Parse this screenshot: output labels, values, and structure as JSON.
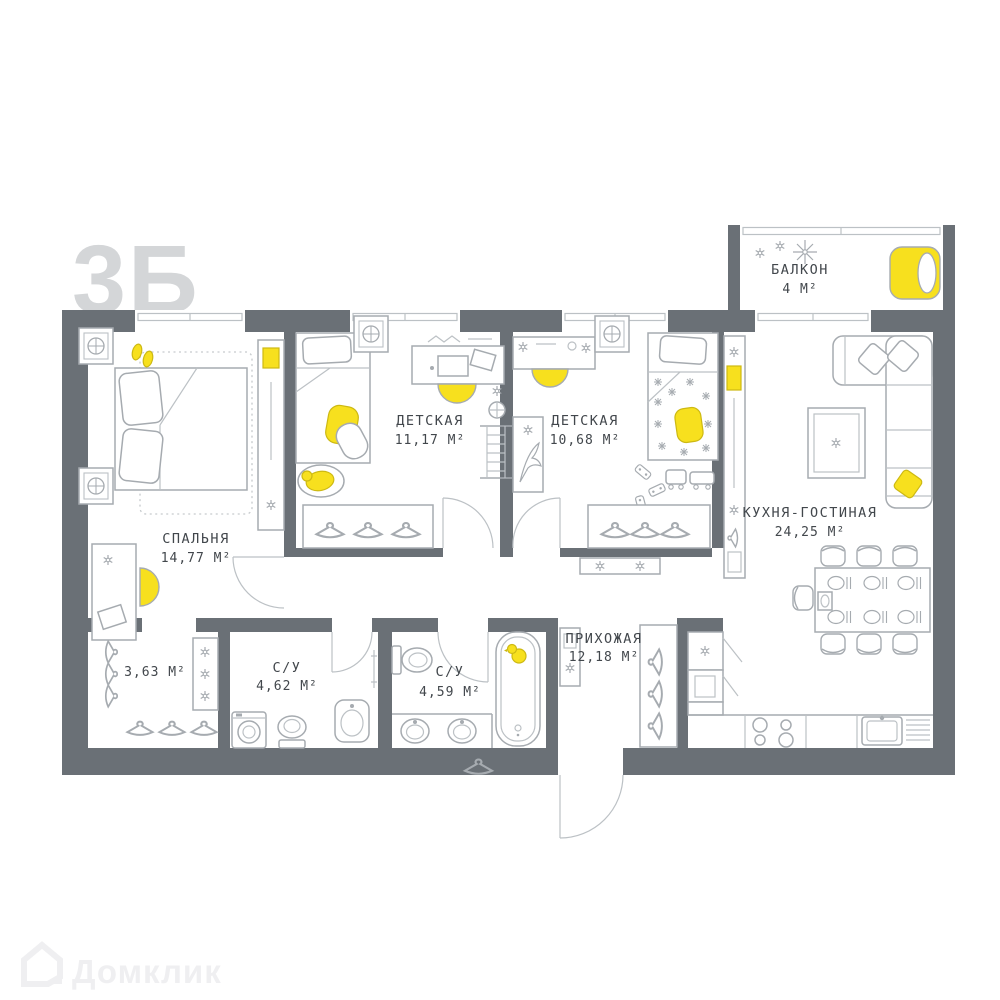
{
  "plan_code": "3Б",
  "watermark": "Домклик",
  "rooms": {
    "balcony": {
      "name": "БАЛКОН",
      "area": "4 М²"
    },
    "bedroom": {
      "name": "СПАЛЬНЯ",
      "area": "14,77 М²"
    },
    "kids1": {
      "name": "ДЕТСКАЯ",
      "area": "11,17 М²"
    },
    "kids2": {
      "name": "ДЕТСКАЯ",
      "area": "10,68 М²"
    },
    "kitchen": {
      "name": "КУХНЯ-ГОСТИНАЯ",
      "area": "24,25 М²"
    },
    "hall": {
      "name": "ПРИХОЖАЯ",
      "area": "12,18 М²"
    },
    "closet": {
      "area": "3,63 М²"
    },
    "bath1": {
      "name": "С/У",
      "area": "4,62 М²"
    },
    "bath2": {
      "name": "С/У",
      "area": "4,59 М²"
    }
  },
  "colors": {
    "wall": "#6a7076",
    "accent_yellow": "#f7e01e",
    "furniture_stroke": "#a6abb0",
    "label": "#42474c",
    "watermark": "#d4d6d8"
  }
}
